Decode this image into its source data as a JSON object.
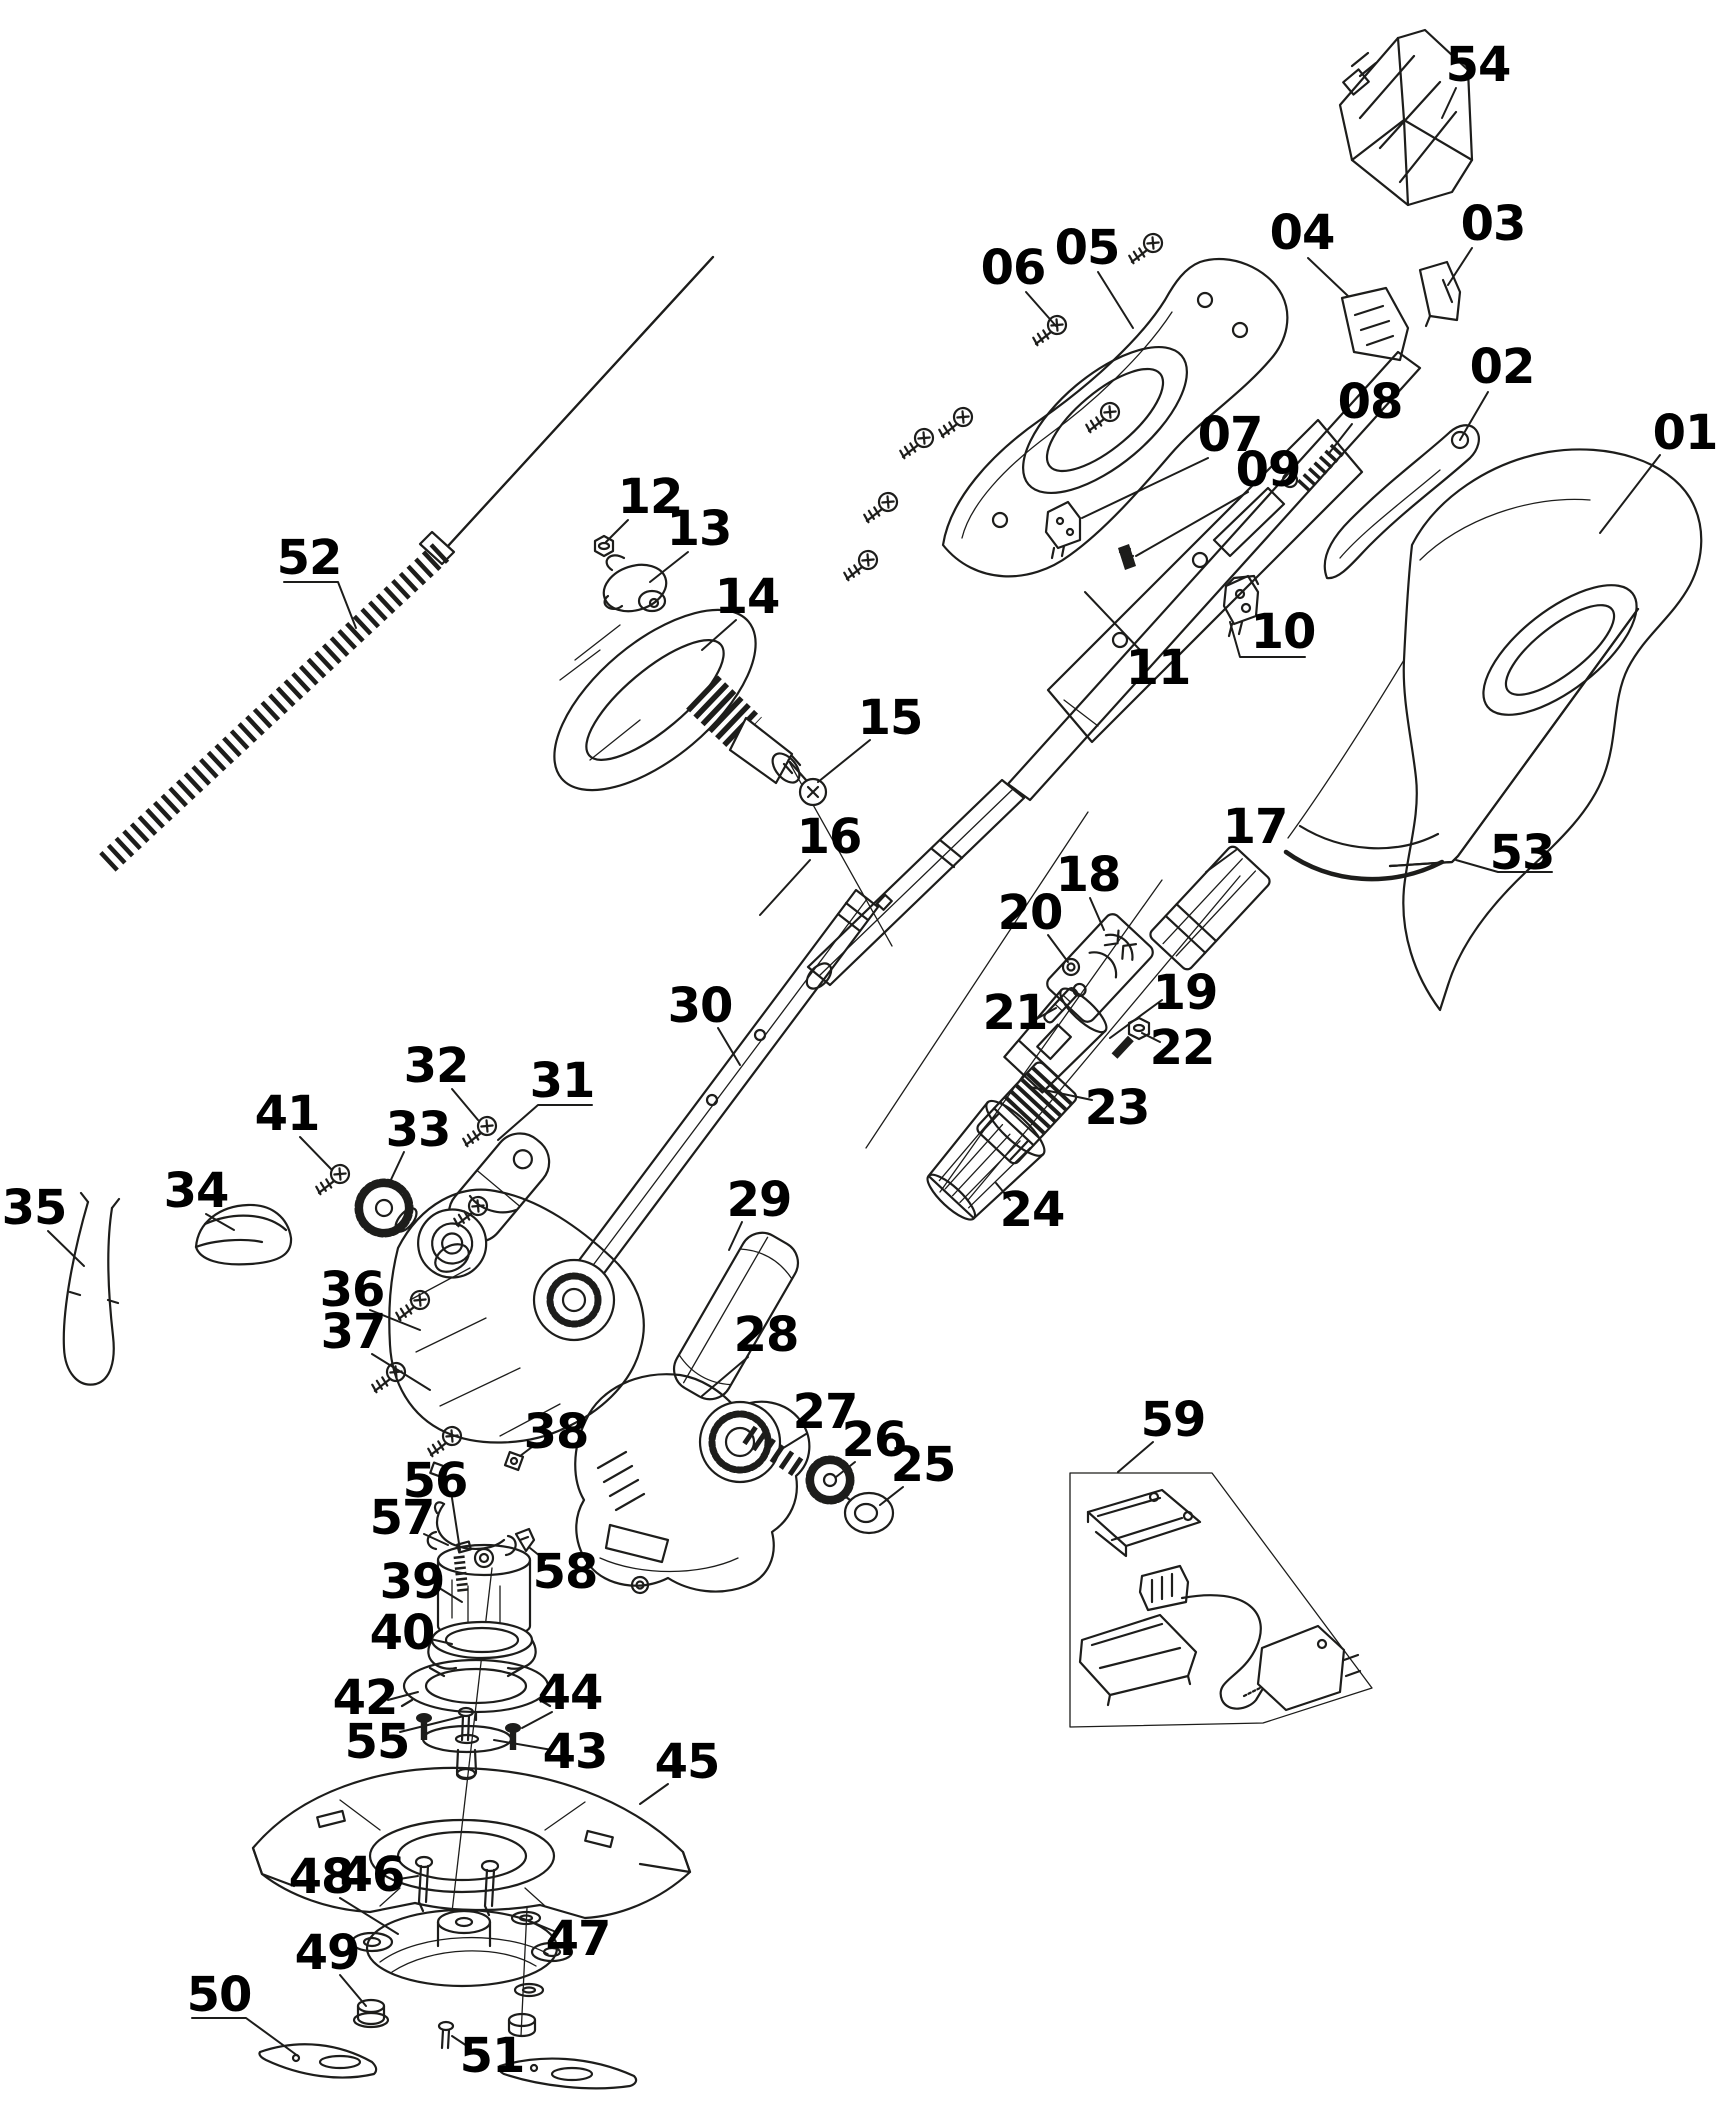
{
  "diagram": {
    "canvas": {
      "width": 1729,
      "height": 2126,
      "background": "#ffffff"
    },
    "style": {
      "line_color": "#1d1d1b",
      "label_color": "#000000",
      "label_font_size": 48,
      "label_font_weight": "bold"
    },
    "labels": [
      {
        "id": "01",
        "text": "01",
        "x": 1685,
        "y": 433,
        "leader": [
          [
            1660,
            455
          ],
          [
            1600,
            533
          ]
        ]
      },
      {
        "id": "02",
        "text": "02",
        "x": 1502,
        "y": 367,
        "leader": [
          [
            1488,
            392
          ],
          [
            1460,
            440
          ]
        ]
      },
      {
        "id": "03",
        "text": "03",
        "x": 1493,
        "y": 224,
        "leader": [
          [
            1472,
            248
          ],
          [
            1448,
            285
          ]
        ]
      },
      {
        "id": "04",
        "text": "04",
        "x": 1302,
        "y": 233,
        "leader": [
          [
            1308,
            258
          ],
          [
            1348,
            296
          ]
        ]
      },
      {
        "id": "05",
        "text": "05",
        "x": 1087,
        "y": 248,
        "leader": [
          [
            1098,
            272
          ],
          [
            1133,
            328
          ]
        ]
      },
      {
        "id": "06",
        "text": "06",
        "x": 1013,
        "y": 268,
        "leader": [
          [
            1026,
            292
          ],
          [
            1056,
            326
          ]
        ]
      },
      {
        "id": "07",
        "text": "07",
        "x": 1230,
        "y": 435,
        "leader": [
          [
            1208,
            458
          ],
          [
            1082,
            518
          ]
        ]
      },
      {
        "id": "08",
        "text": "08",
        "x": 1370,
        "y": 402,
        "leader": [
          [
            1352,
            424
          ],
          [
            1330,
            452
          ]
        ]
      },
      {
        "id": "09",
        "text": "09",
        "x": 1268,
        "y": 470,
        "leader": [
          [
            1248,
            492
          ],
          [
            1136,
            556
          ]
        ]
      },
      {
        "id": "10",
        "text": "10",
        "x": 1283,
        "y": 632,
        "leader": [
          [
            1305,
            657
          ],
          [
            1240,
            657
          ],
          [
            1230,
            622
          ]
        ]
      },
      {
        "id": "11",
        "text": "11",
        "x": 1158,
        "y": 668,
        "leader": [
          [
            1140,
            650
          ],
          [
            1085,
            592
          ]
        ]
      },
      {
        "id": "12",
        "text": "12",
        "x": 650,
        "y": 497,
        "leader": [
          [
            628,
            520
          ],
          [
            606,
            542
          ]
        ]
      },
      {
        "id": "13",
        "text": "13",
        "x": 699,
        "y": 529,
        "leader": [
          [
            688,
            552
          ],
          [
            650,
            582
          ]
        ]
      },
      {
        "id": "14",
        "text": "14",
        "x": 747,
        "y": 597,
        "leader": [
          [
            736,
            620
          ],
          [
            702,
            650
          ]
        ]
      },
      {
        "id": "15",
        "text": "15",
        "x": 890,
        "y": 718,
        "leader": [
          [
            870,
            740
          ],
          [
            818,
            782
          ]
        ]
      },
      {
        "id": "16",
        "text": "16",
        "x": 829,
        "y": 837,
        "leader": [
          [
            810,
            860
          ],
          [
            760,
            915
          ]
        ]
      },
      {
        "id": "17",
        "text": "17",
        "x": 1255,
        "y": 827,
        "leader": [
          [
            1236,
            850
          ],
          [
            1206,
            872
          ]
        ]
      },
      {
        "id": "18",
        "text": "18",
        "x": 1088,
        "y": 875,
        "leader": [
          [
            1090,
            898
          ],
          [
            1104,
            930
          ]
        ]
      },
      {
        "id": "19",
        "text": "19",
        "x": 1185,
        "y": 993,
        "leader": [
          [
            1162,
            1000
          ],
          [
            1110,
            1038
          ]
        ]
      },
      {
        "id": "20",
        "text": "20",
        "x": 1030,
        "y": 913,
        "leader": [
          [
            1048,
            935
          ],
          [
            1068,
            962
          ]
        ]
      },
      {
        "id": "21",
        "text": "21",
        "x": 1015,
        "y": 1013,
        "leader": [
          [
            1038,
            1018
          ],
          [
            1056,
            1008
          ]
        ]
      },
      {
        "id": "22",
        "text": "22",
        "x": 1182,
        "y": 1048,
        "leader": [
          [
            1160,
            1042
          ],
          [
            1142,
            1033
          ]
        ]
      },
      {
        "id": "23",
        "text": "23",
        "x": 1117,
        "y": 1108,
        "leader": [
          [
            1092,
            1100
          ],
          [
            1030,
            1087
          ]
        ]
      },
      {
        "id": "24",
        "text": "24",
        "x": 1032,
        "y": 1210,
        "leader": [
          [
            1010,
            1200
          ],
          [
            996,
            1183
          ]
        ]
      },
      {
        "id": "25",
        "text": "25",
        "x": 923,
        "y": 1465,
        "leader": [
          [
            903,
            1487
          ],
          [
            880,
            1505
          ]
        ]
      },
      {
        "id": "26",
        "text": "26",
        "x": 874,
        "y": 1440,
        "leader": [
          [
            855,
            1462
          ],
          [
            836,
            1477
          ]
        ]
      },
      {
        "id": "27",
        "text": "27",
        "x": 825,
        "y": 1412,
        "leader": [
          [
            806,
            1434
          ],
          [
            780,
            1450
          ]
        ]
      },
      {
        "id": "28",
        "text": "28",
        "x": 766,
        "y": 1335,
        "leader": [
          [
            748,
            1357
          ],
          [
            702,
            1396
          ]
        ]
      },
      {
        "id": "29",
        "text": "29",
        "x": 759,
        "y": 1200,
        "leader": [
          [
            742,
            1222
          ],
          [
            729,
            1250
          ]
        ]
      },
      {
        "id": "30",
        "text": "30",
        "x": 700,
        "y": 1006,
        "leader": [
          [
            718,
            1028
          ],
          [
            740,
            1065
          ]
        ]
      },
      {
        "id": "31",
        "text": "31",
        "x": 562,
        "y": 1081,
        "leader": [
          [
            592,
            1105
          ],
          [
            538,
            1105
          ],
          [
            498,
            1140
          ]
        ]
      },
      {
        "id": "32",
        "text": "32",
        "x": 436,
        "y": 1066,
        "leader": [
          [
            452,
            1089
          ],
          [
            478,
            1120
          ]
        ]
      },
      {
        "id": "33",
        "text": "33",
        "x": 418,
        "y": 1130,
        "leader": [
          [
            404,
            1152
          ],
          [
            388,
            1186
          ]
        ]
      },
      {
        "id": "34",
        "text": "34",
        "x": 196,
        "y": 1191,
        "leader": [
          [
            206,
            1214
          ],
          [
            234,
            1230
          ]
        ]
      },
      {
        "id": "35",
        "text": "35",
        "x": 34,
        "y": 1208,
        "leader": [
          [
            48,
            1231
          ],
          [
            84,
            1266
          ]
        ]
      },
      {
        "id": "36",
        "text": "36",
        "x": 352,
        "y": 1290,
        "leader": [
          [
            370,
            1310
          ],
          [
            420,
            1330
          ]
        ]
      },
      {
        "id": "37",
        "text": "37",
        "x": 353,
        "y": 1332,
        "leader": [
          [
            372,
            1354
          ],
          [
            430,
            1390
          ]
        ]
      },
      {
        "id": "38",
        "text": "38",
        "x": 556,
        "y": 1432,
        "leader": [
          [
            536,
            1444
          ],
          [
            520,
            1456
          ]
        ]
      },
      {
        "id": "39",
        "text": "39",
        "x": 412,
        "y": 1582,
        "leader": [
          [
            436,
            1586
          ],
          [
            462,
            1602
          ]
        ]
      },
      {
        "id": "40",
        "text": "40",
        "x": 402,
        "y": 1633,
        "leader": [
          [
            426,
            1638
          ],
          [
            452,
            1644
          ]
        ]
      },
      {
        "id": "41",
        "text": "41",
        "x": 287,
        "y": 1114,
        "leader": [
          [
            300,
            1137
          ],
          [
            332,
            1170
          ]
        ]
      },
      {
        "id": "42",
        "text": "42",
        "x": 365,
        "y": 1698,
        "leader": [
          [
            388,
            1700
          ],
          [
            418,
            1692
          ]
        ]
      },
      {
        "id": "43",
        "text": "43",
        "x": 575,
        "y": 1752,
        "leader": [
          [
            552,
            1750
          ],
          [
            494,
            1740
          ]
        ]
      },
      {
        "id": "44",
        "text": "44",
        "x": 570,
        "y": 1693,
        "leader": [
          [
            552,
            1712
          ],
          [
            522,
            1728
          ]
        ]
      },
      {
        "id": "45",
        "text": "45",
        "x": 687,
        "y": 1762,
        "leader": [
          [
            668,
            1784
          ],
          [
            640,
            1804
          ]
        ]
      },
      {
        "id": "46",
        "text": "46",
        "x": 372,
        "y": 1875,
        "leader": [
          [
            393,
            1880
          ],
          [
            418,
            1876
          ]
        ]
      },
      {
        "id": "47",
        "text": "47",
        "x": 578,
        "y": 1939,
        "leader": [
          [
            556,
            1932
          ],
          [
            532,
            1922
          ]
        ]
      },
      {
        "id": "48",
        "text": "48",
        "x": 321,
        "y": 1877,
        "leader": [
          [
            340,
            1898
          ],
          [
            398,
            1934
          ]
        ]
      },
      {
        "id": "49",
        "text": "49",
        "x": 327,
        "y": 1953,
        "leader": [
          [
            340,
            1975
          ],
          [
            366,
            2006
          ]
        ]
      },
      {
        "id": "50",
        "text": "50",
        "x": 219,
        "y": 1995,
        "leader": [
          [
            192,
            2018
          ],
          [
            246,
            2018
          ],
          [
            298,
            2056
          ]
        ]
      },
      {
        "id": "51",
        "text": "51",
        "x": 492,
        "y": 2056,
        "leader": [
          [
            470,
            2048
          ],
          [
            452,
            2036
          ]
        ]
      },
      {
        "id": "52",
        "text": "52",
        "x": 309,
        "y": 558,
        "leader": [
          [
            284,
            582
          ],
          [
            338,
            582
          ],
          [
            356,
            628
          ]
        ]
      },
      {
        "id": "53",
        "text": "53",
        "x": 1522,
        "y": 853,
        "leader": [
          [
            1552,
            872
          ],
          [
            1498,
            872
          ],
          [
            1456,
            860
          ]
        ]
      },
      {
        "id": "54",
        "text": "54",
        "x": 1478,
        "y": 65,
        "leader": [
          [
            1456,
            88
          ],
          [
            1442,
            118
          ]
        ]
      },
      {
        "id": "55",
        "text": "55",
        "x": 377,
        "y": 1742,
        "leader": [
          [
            400,
            1732
          ],
          [
            464,
            1716
          ]
        ]
      },
      {
        "id": "56",
        "text": "56",
        "x": 435,
        "y": 1481,
        "leader": [
          [
            452,
            1498
          ],
          [
            460,
            1550
          ]
        ]
      },
      {
        "id": "57",
        "text": "57",
        "x": 402,
        "y": 1518,
        "leader": [
          [
            424,
            1534
          ],
          [
            448,
            1545
          ]
        ]
      },
      {
        "id": "58",
        "text": "58",
        "x": 565,
        "y": 1572,
        "leader": [
          [
            545,
            1560
          ],
          [
            530,
            1548
          ]
        ]
      },
      {
        "id": "59",
        "text": "59",
        "x": 1173,
        "y": 1420,
        "leader": [
          [
            1153,
            1442
          ],
          [
            1118,
            1472
          ]
        ]
      }
    ]
  }
}
